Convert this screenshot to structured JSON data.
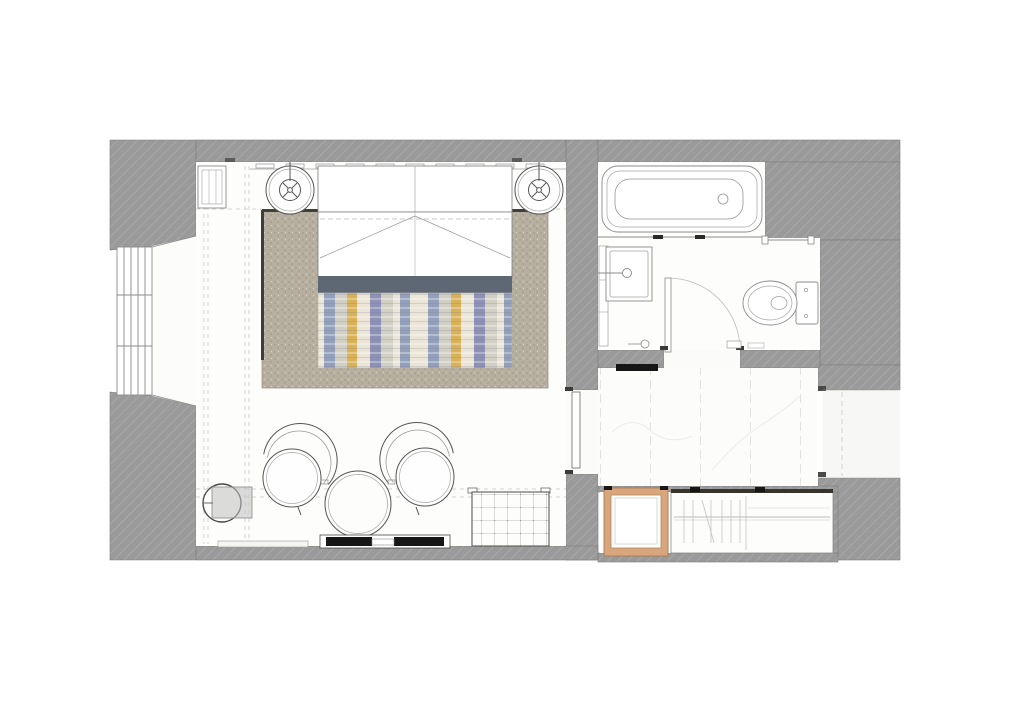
{
  "document": {
    "kind": "floor-plan-drawing"
  },
  "colors": {
    "page_background": "#ffffff",
    "wall_gray": "#9b9a9b",
    "room_floor": "#fdfdfc",
    "corridor_floor": "#f7f7f5",
    "line_dark": "#555555",
    "line_mid": "#8b8b8b",
    "line_light": "#c9c9c7",
    "dash_light": "#d4d4d1",
    "rug_base": "#b7afa0",
    "rug_dot": "#a59c89",
    "rug_edge_dark": "#3f3e3c",
    "bed_band": "#5d6874",
    "throw_cream": "#eae5d7",
    "throw_gray": "#d2cfc4",
    "throw_blue": "#93a0bb",
    "throw_purple": "#8e91b6",
    "throw_ochre": "#d9b157",
    "wood_frame": "#d8a57c",
    "wood_frame_dark": "#a97c50",
    "black_detail": "#161616",
    "wardrobe_top_bar": "#3a332c",
    "side_table_gray": "#c0c0c0"
  }
}
